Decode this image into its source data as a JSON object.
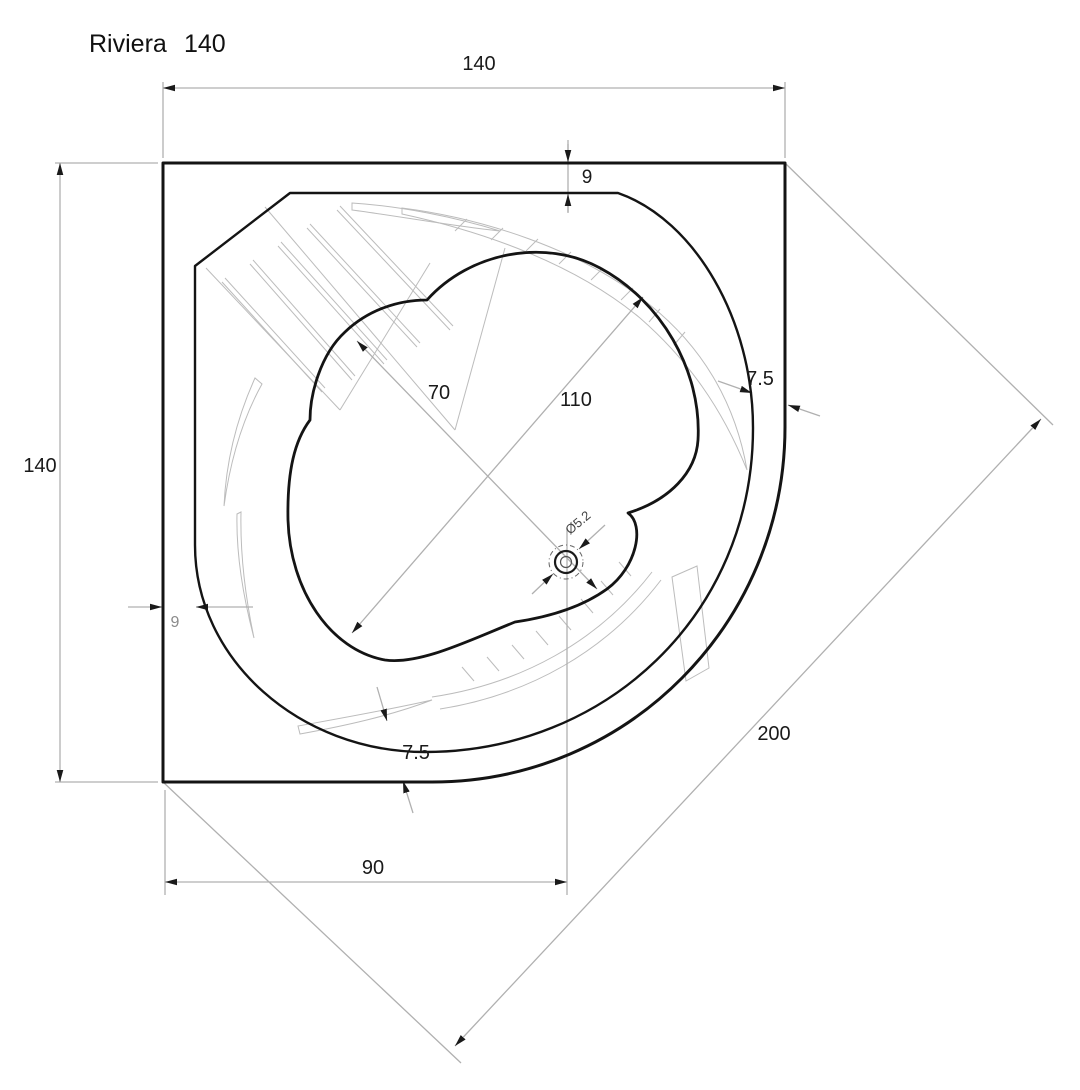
{
  "title": {
    "brand": "Riviera",
    "model": "140"
  },
  "drawing": {
    "type": "technical plan drawing, corner bathtub top view",
    "style": "black line-art on white, gray dimension lines"
  },
  "dimensions": {
    "top_width": "140",
    "left_height": "140",
    "rim_top": "9",
    "rim_left": "9",
    "rim_right": "7.5",
    "rim_bottom": "7.5",
    "basin_diag_long": "110",
    "basin_diag_short": "70",
    "drain_from_left": "90",
    "front_edge": "200",
    "drain_diameter": "Ø5.2"
  },
  "colors": {
    "line": "#141414",
    "dim_line": "#b0b0b0",
    "texture_line": "#bcbcbc",
    "text": "#1a1a1a",
    "muted_text": "#8a8a8a",
    "background": "#ffffff"
  }
}
